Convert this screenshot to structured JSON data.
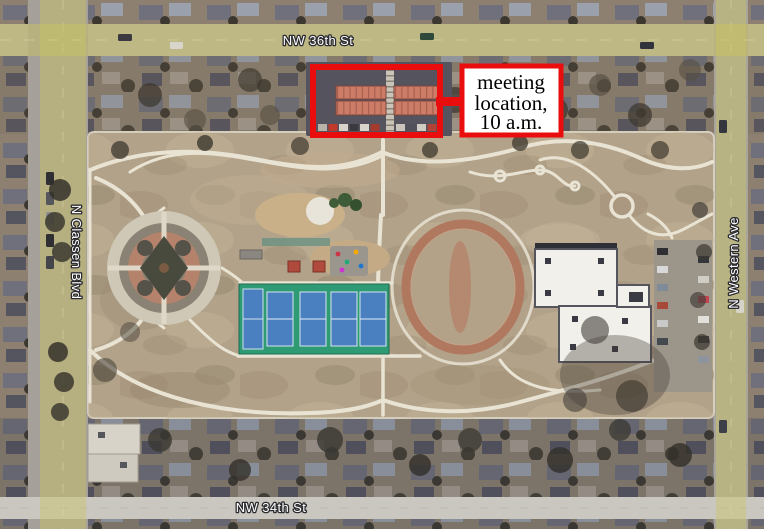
{
  "map": {
    "street_labels": {
      "top": "NW 36th St",
      "bottom": "NW 34th St",
      "left": "N Classen Blvd",
      "right": "N Western Ave"
    },
    "colors": {
      "road_highlight": "#cdc55f",
      "park_ground": "#b2a28a",
      "path": "#e9e3d3",
      "court_green": "#2f9b74",
      "court_blue": "#4a7fc0",
      "track_ring": "#b0795f",
      "large_building_roof": "#f1f0ea",
      "meeting_building_roof": "#cd7c68"
    }
  },
  "annotation": {
    "callout_lines": {
      "line1": "meeting",
      "line2": "location,",
      "line3": "10 a.m."
    },
    "red": "#ea0d0d",
    "box_fill": "#ffffff",
    "text_color": "#000000"
  }
}
